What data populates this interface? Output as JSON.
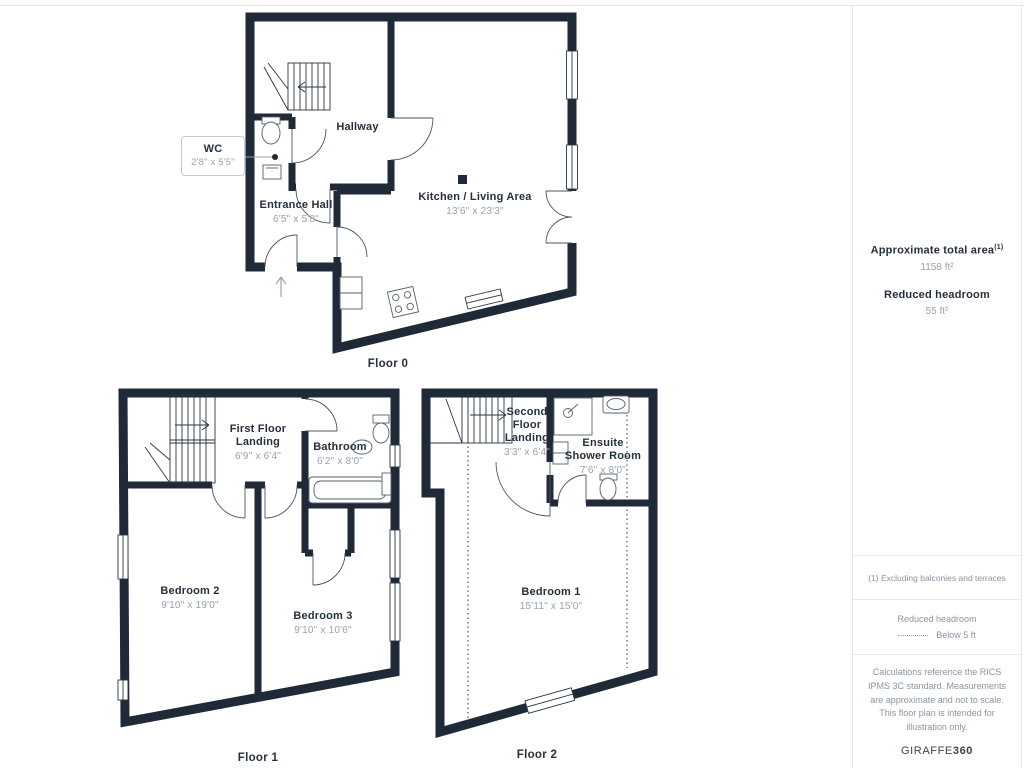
{
  "colors": {
    "wall": "#1f2937",
    "room_name_text": "#26303d",
    "dimension_text": "#98a1ad",
    "divider": "#e6e7ea"
  },
  "floors": [
    {
      "label": "Floor 0",
      "rooms": [
        {
          "name": "WC",
          "dims": "2'8\" x 5'5\""
        },
        {
          "name": "Hallway",
          "dims": ""
        },
        {
          "name": "Entrance Hall",
          "dims": "6'5\" x 5'8\""
        },
        {
          "name": "Kitchen / Living Area",
          "dims": "13'6\" x 23'3\""
        }
      ]
    },
    {
      "label": "Floor 1",
      "rooms": [
        {
          "name": "First Floor Landing",
          "dims": "6'9\" x 6'4\""
        },
        {
          "name": "Bathroom",
          "dims": "6'2\" x 8'0\""
        },
        {
          "name": "Bedroom 2",
          "dims": "9'10\" x 19'0\""
        },
        {
          "name": "Bedroom 3",
          "dims": "9'10\" x 10'6\""
        }
      ]
    },
    {
      "label": "Floor 2",
      "rooms": [
        {
          "name": "Second Floor Landing",
          "dims": "3'3\" x 6'4\""
        },
        {
          "name": "Ensuite Shower Room",
          "dims": "7'6\" x 8'0\""
        },
        {
          "name": "Bedroom 1",
          "dims": "15'11\" x 15'0\""
        }
      ]
    }
  ],
  "sidebar": {
    "total_area_label": "Approximate total area",
    "total_area_superscript": "(1)",
    "total_area_value": "1158 ft²",
    "reduced_headroom_label": "Reduced headroom",
    "reduced_headroom_value": "55 ft²",
    "footnote": "(1) Excluding balconies and terraces",
    "legend_title": "Reduced headroom",
    "legend_value": "Below 5 ft",
    "disclaimer": "Calculations reference the RICS IPMS 3C standard. Measurements are approximate and not to scale. This floor plan is intended for illustration only.",
    "brand_name": "GIRAFFE",
    "brand_number": "360"
  }
}
